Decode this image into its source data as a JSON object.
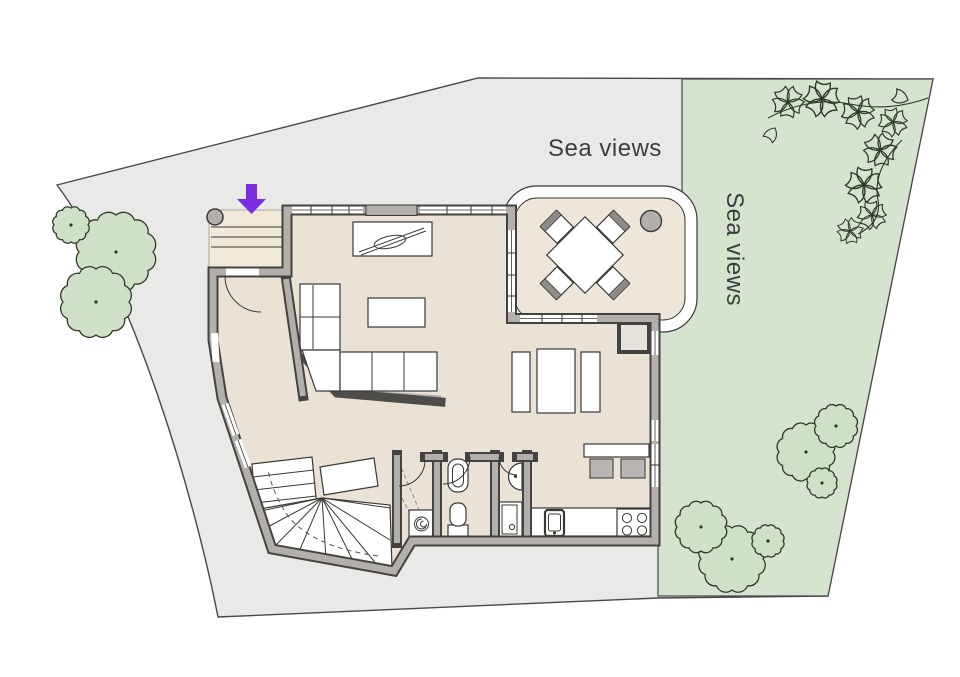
{
  "labels": {
    "sea_views_top": "Sea views",
    "sea_views_side": "Sea views"
  },
  "colors": {
    "plot-gray": "#e9e9e7",
    "garden-green": "#d6e3cf",
    "floor-beige": "#eae2d4",
    "porch-beige": "#f1ead9",
    "terrace-beige": "#ede6d9",
    "wall-gray": "#b3b0ac",
    "wall-dark": "#45433f",
    "line-dark": "#3a3936",
    "boundary-line": "#4a4846",
    "tree-fill": "#cfe0c6",
    "tree-line": "#2d3a2a",
    "arrow-purple": "#7c2ce0",
    "label-text": "#3d3d3d",
    "stool-gray": "#b9b6b2"
  },
  "site": {
    "type": "ground-floor site plan",
    "views": [
      "sea view to the north",
      "sea view to the east garden"
    ],
    "entrance_marker": "purple arrow at front door"
  },
  "garden": {
    "tree_clusters": [
      [
        {
          "cx": 116,
          "cy": 252,
          "r": 37
        },
        {
          "cx": 71,
          "cy": 225,
          "r": 17
        },
        {
          "cx": 96,
          "cy": 302,
          "r": 33
        }
      ],
      [
        {
          "cx": 806,
          "cy": 452,
          "r": 27
        },
        {
          "cx": 836,
          "cy": 426,
          "r": 20
        },
        {
          "cx": 822,
          "cy": 483,
          "r": 14
        }
      ],
      [
        {
          "cx": 732,
          "cy": 559,
          "r": 31
        },
        {
          "cx": 701,
          "cy": 527,
          "r": 24
        },
        {
          "cx": 768,
          "cy": 541,
          "r": 15
        }
      ]
    ]
  },
  "house": {
    "rooms": [
      "entrance porch",
      "entrance hall",
      "living room",
      "dining area",
      "kitchen",
      "wc",
      "shower room",
      "utility store",
      "staircase",
      "terrace"
    ],
    "furniture": [
      "l-shaped sofa",
      "coffee table",
      "tv sideboard",
      "dining table with chairs",
      "stove cabinet",
      "breakfast bar with stools",
      "kitchen sink",
      "hob",
      "washing machine",
      "toilet",
      "wc with cistern",
      "wall basin",
      "shower tray",
      "terrace table with four chairs"
    ]
  }
}
